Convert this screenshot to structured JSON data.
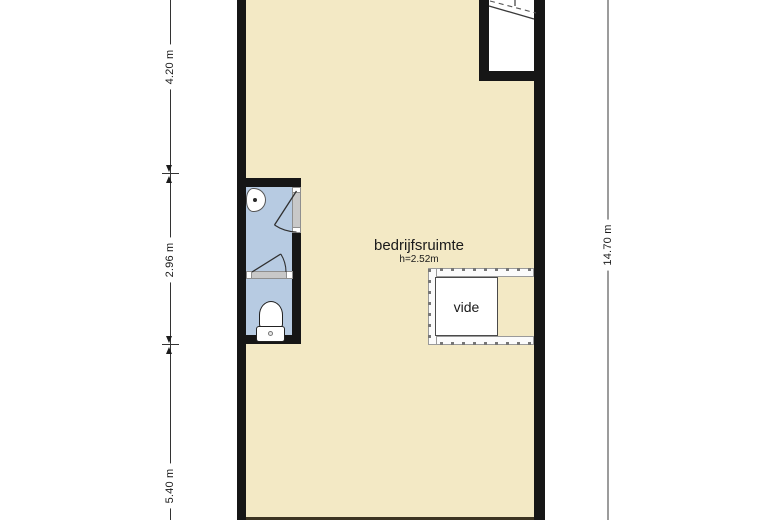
{
  "plan": {
    "room": {
      "label": "bedrijfsruimte",
      "ceiling_height": "h=2.52m"
    },
    "vide": {
      "label": "vide"
    },
    "dimensions": {
      "left": [
        {
          "label": "4.20 m"
        },
        {
          "label": "2.96 m"
        },
        {
          "label": "5.40 m"
        }
      ],
      "right": [
        {
          "label": "14.70 m"
        }
      ]
    },
    "colors": {
      "floor": "#f3e9c5",
      "wall": "#161616",
      "bathroom_floor": "#b7cbe2",
      "door_opening": "#c8c8c8",
      "right_dim_line": "#9c9c9c",
      "text": "#1a1a1a"
    },
    "fixtures": [
      {
        "name": "sink"
      },
      {
        "name": "toilet"
      },
      {
        "name": "staircase"
      },
      {
        "name": "vide-railing"
      }
    ]
  }
}
